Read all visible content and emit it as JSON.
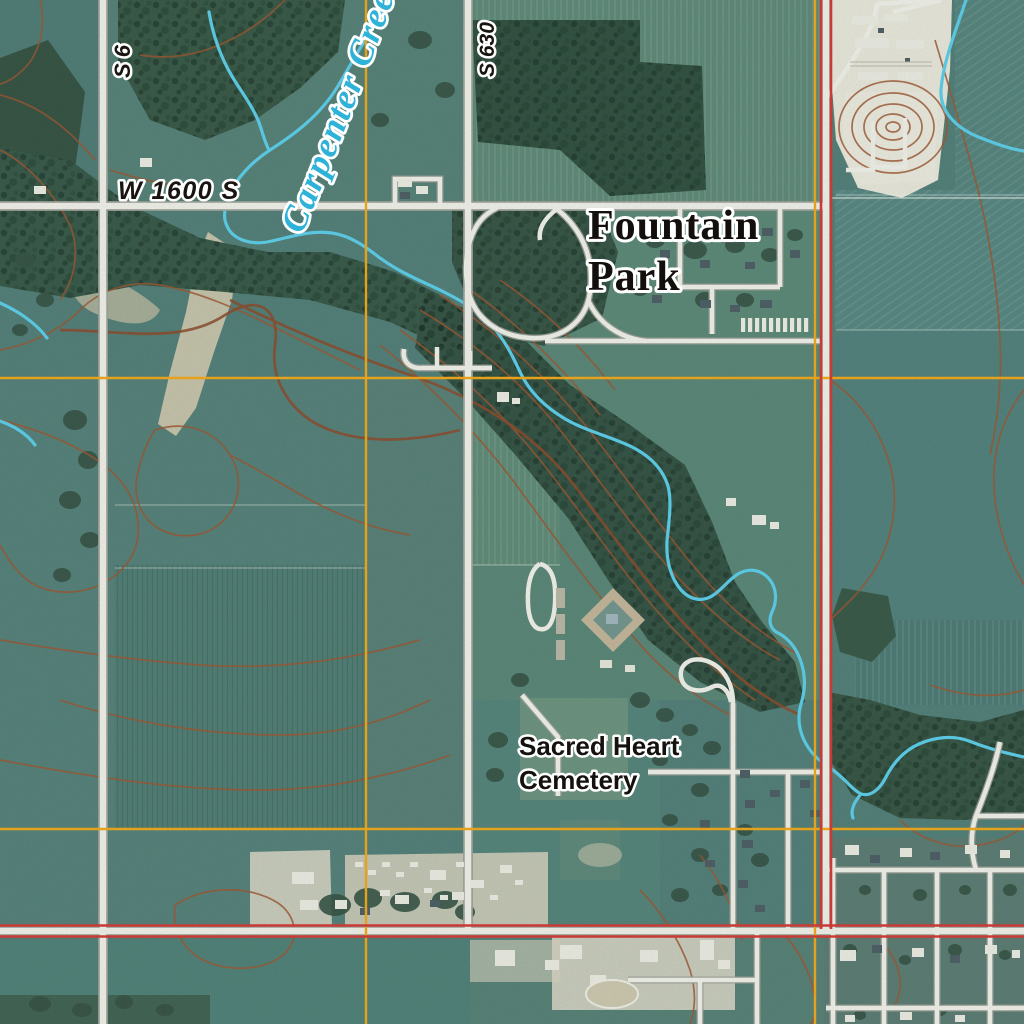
{
  "map": {
    "type": "usgs-topo-orthoimagery",
    "labels": {
      "creek": "Carpenter Creek",
      "road_w": "W 1600 S",
      "road_s630": "S 630",
      "road_s6": "S 6",
      "park": [
        "Fountain",
        "Park"
      ],
      "cemetery": [
        "Sacred Heart",
        "Cemetery"
      ]
    },
    "colors": {
      "field_teal": "#4d7870",
      "woods_dark": "#31503c",
      "road_fill": "#f2f0e7",
      "road_casing": "#9c9c92",
      "boundary_red": "#d2302a",
      "grid_orange": "#f2a30e",
      "water_cyan": "#57cbe6",
      "water_label_blue": "#2fb2d8",
      "contour_brown": "#9b4e26",
      "contour_index_brown": "#8a4220",
      "sand_tan": "#d2c7aa",
      "industrial_white": "#e9e5d7",
      "label_black": "#14110e",
      "halo_white": "#ffffff"
    }
  }
}
